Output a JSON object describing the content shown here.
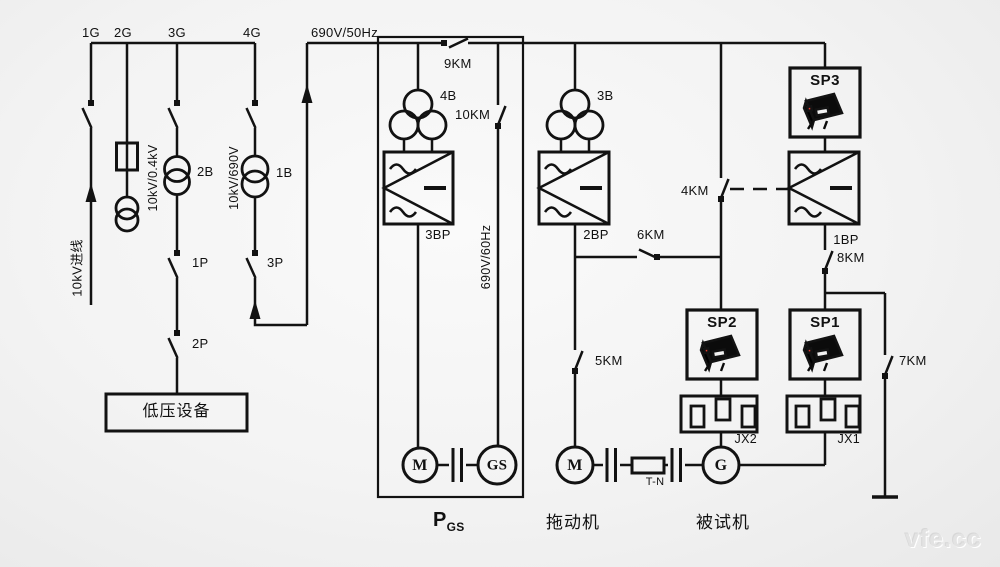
{
  "diagram": {
    "feeders": {
      "f1": "1G",
      "f2": "2G",
      "f3": "3G",
      "f4": "4G"
    },
    "buses": {
      "main_bus": "690V/50Hz",
      "converter_out_bus": "690V/60Hz",
      "incoming_line": "10kV进线"
    },
    "transformers": {
      "t1b": "1B",
      "t2b": "2B",
      "t3b": "3B",
      "t4b": "4B",
      "ratio_t2b": "10kV/0.4kV",
      "ratio_t1b": "10kV/690V"
    },
    "switches": {
      "p1": "1P",
      "p2": "2P",
      "p3": "3P",
      "km4": "4KM",
      "km5": "5KM",
      "km6": "6KM",
      "km7": "7KM",
      "km8": "8KM",
      "km9": "9KM",
      "km10": "10KM"
    },
    "converters": {
      "bp1": "1BP",
      "bp2": "2BP",
      "bp3": "3BP"
    },
    "analyzers": {
      "sp1": "SP1",
      "sp2": "SP2",
      "sp3": "SP3"
    },
    "junction_boxes": {
      "jx1": "JX1",
      "jx2": "JX2"
    },
    "machines": {
      "pgs_motor": "M",
      "pgs_generator": "GS",
      "drive_motor": "M",
      "test_generator": "G",
      "torque_sensor": "T-N"
    },
    "captions": {
      "lv_equipment": "低压设备",
      "pgs_main": "P",
      "pgs_sub": "GS",
      "drive_machine": "拖动机",
      "test_machine": "被试机"
    },
    "watermark": "vfe.cc"
  }
}
